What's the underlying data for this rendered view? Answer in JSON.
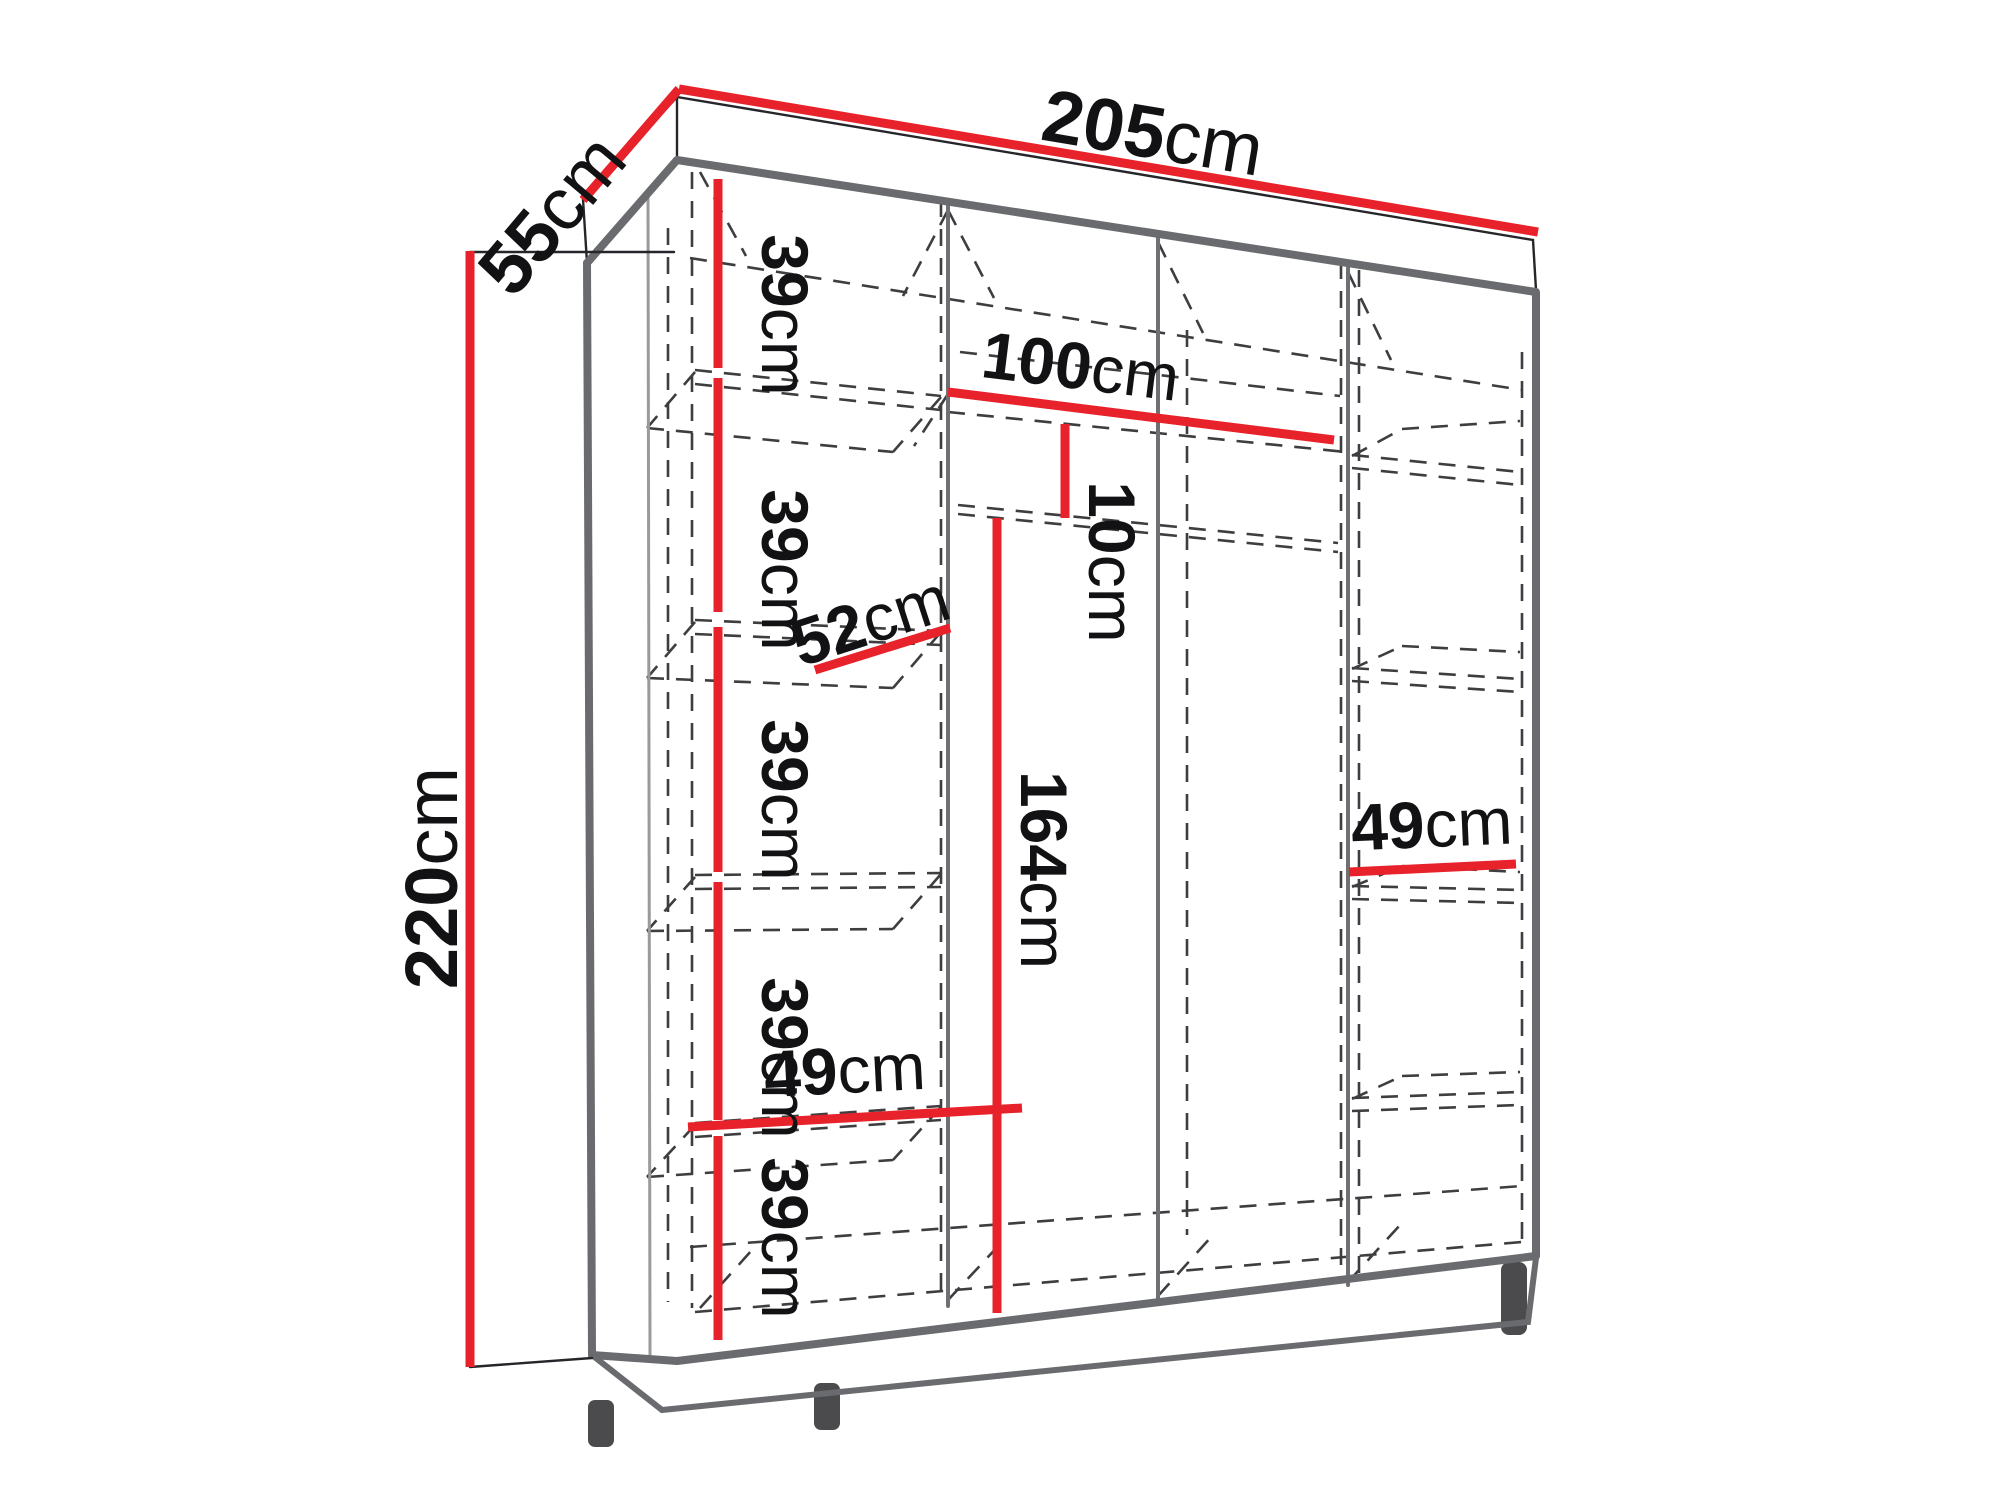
{
  "diagram": {
    "type": "wardrobe-dimension-diagram",
    "colors": {
      "dimension_red": "#e8222a",
      "outline_gray": "#6a6b6e",
      "hidden_line_gray": "#3e3e40",
      "text_black": "#121214",
      "background": "#ffffff"
    }
  },
  "labels": {
    "width": {
      "value": "205",
      "unit": "cm"
    },
    "depth": {
      "value": "55",
      "unit": "cm"
    },
    "height": {
      "value": "220",
      "unit": "cm"
    },
    "shelf_spacing_1": {
      "value": "39",
      "unit": "cm"
    },
    "shelf_spacing_2": {
      "value": "39",
      "unit": "cm"
    },
    "shelf_spacing_3": {
      "value": "39",
      "unit": "cm"
    },
    "shelf_spacing_4": {
      "value": "39",
      "unit": "cm"
    },
    "shelf_spacing_5": {
      "value": "39",
      "unit": "cm"
    },
    "rod_length": {
      "value": "100",
      "unit": "cm"
    },
    "rod_offset": {
      "value": "10",
      "unit": "cm"
    },
    "shelf_depth": {
      "value": "52",
      "unit": "cm"
    },
    "rod_height": {
      "value": "164",
      "unit": "cm"
    },
    "left_shelf_width": {
      "value": "49",
      "unit": "cm"
    },
    "right_shelf_width": {
      "value": "49",
      "unit": "cm"
    }
  }
}
